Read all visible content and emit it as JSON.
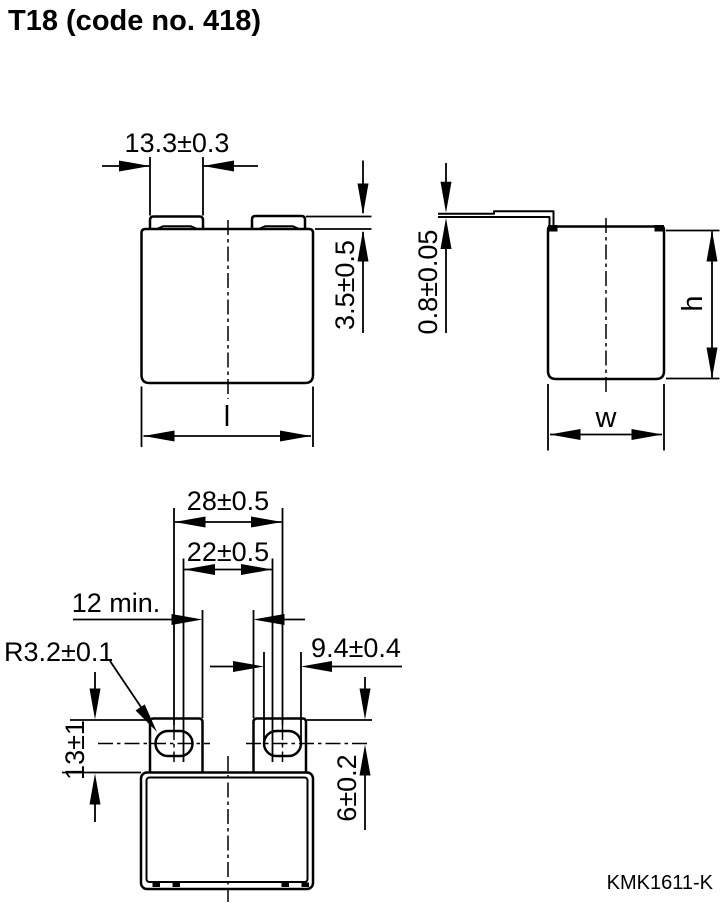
{
  "title": "T18 (code no. 418)",
  "footer_code": "KMK1611-K",
  "colors": {
    "line": "#000000",
    "background": "#ffffff"
  },
  "views": {
    "front": {
      "dims": {
        "tab_width": "13.3±0.3",
        "tab_height": "3.5±0.5",
        "length_label": "l"
      }
    },
    "side": {
      "dims": {
        "lead_thickness": "0.8±0.05",
        "height_label": "h",
        "width_label": "w"
      }
    },
    "bottom": {
      "dims": {
        "outer_span": "28±0.5",
        "inner_span": "22±0.5",
        "terminal_gap": "12 min.",
        "slot_length": "9.4±0.4",
        "slot_radius": "R3.2±0.1",
        "terminal_height": "13±1",
        "hole_center_offset": "6±0.2"
      }
    }
  }
}
